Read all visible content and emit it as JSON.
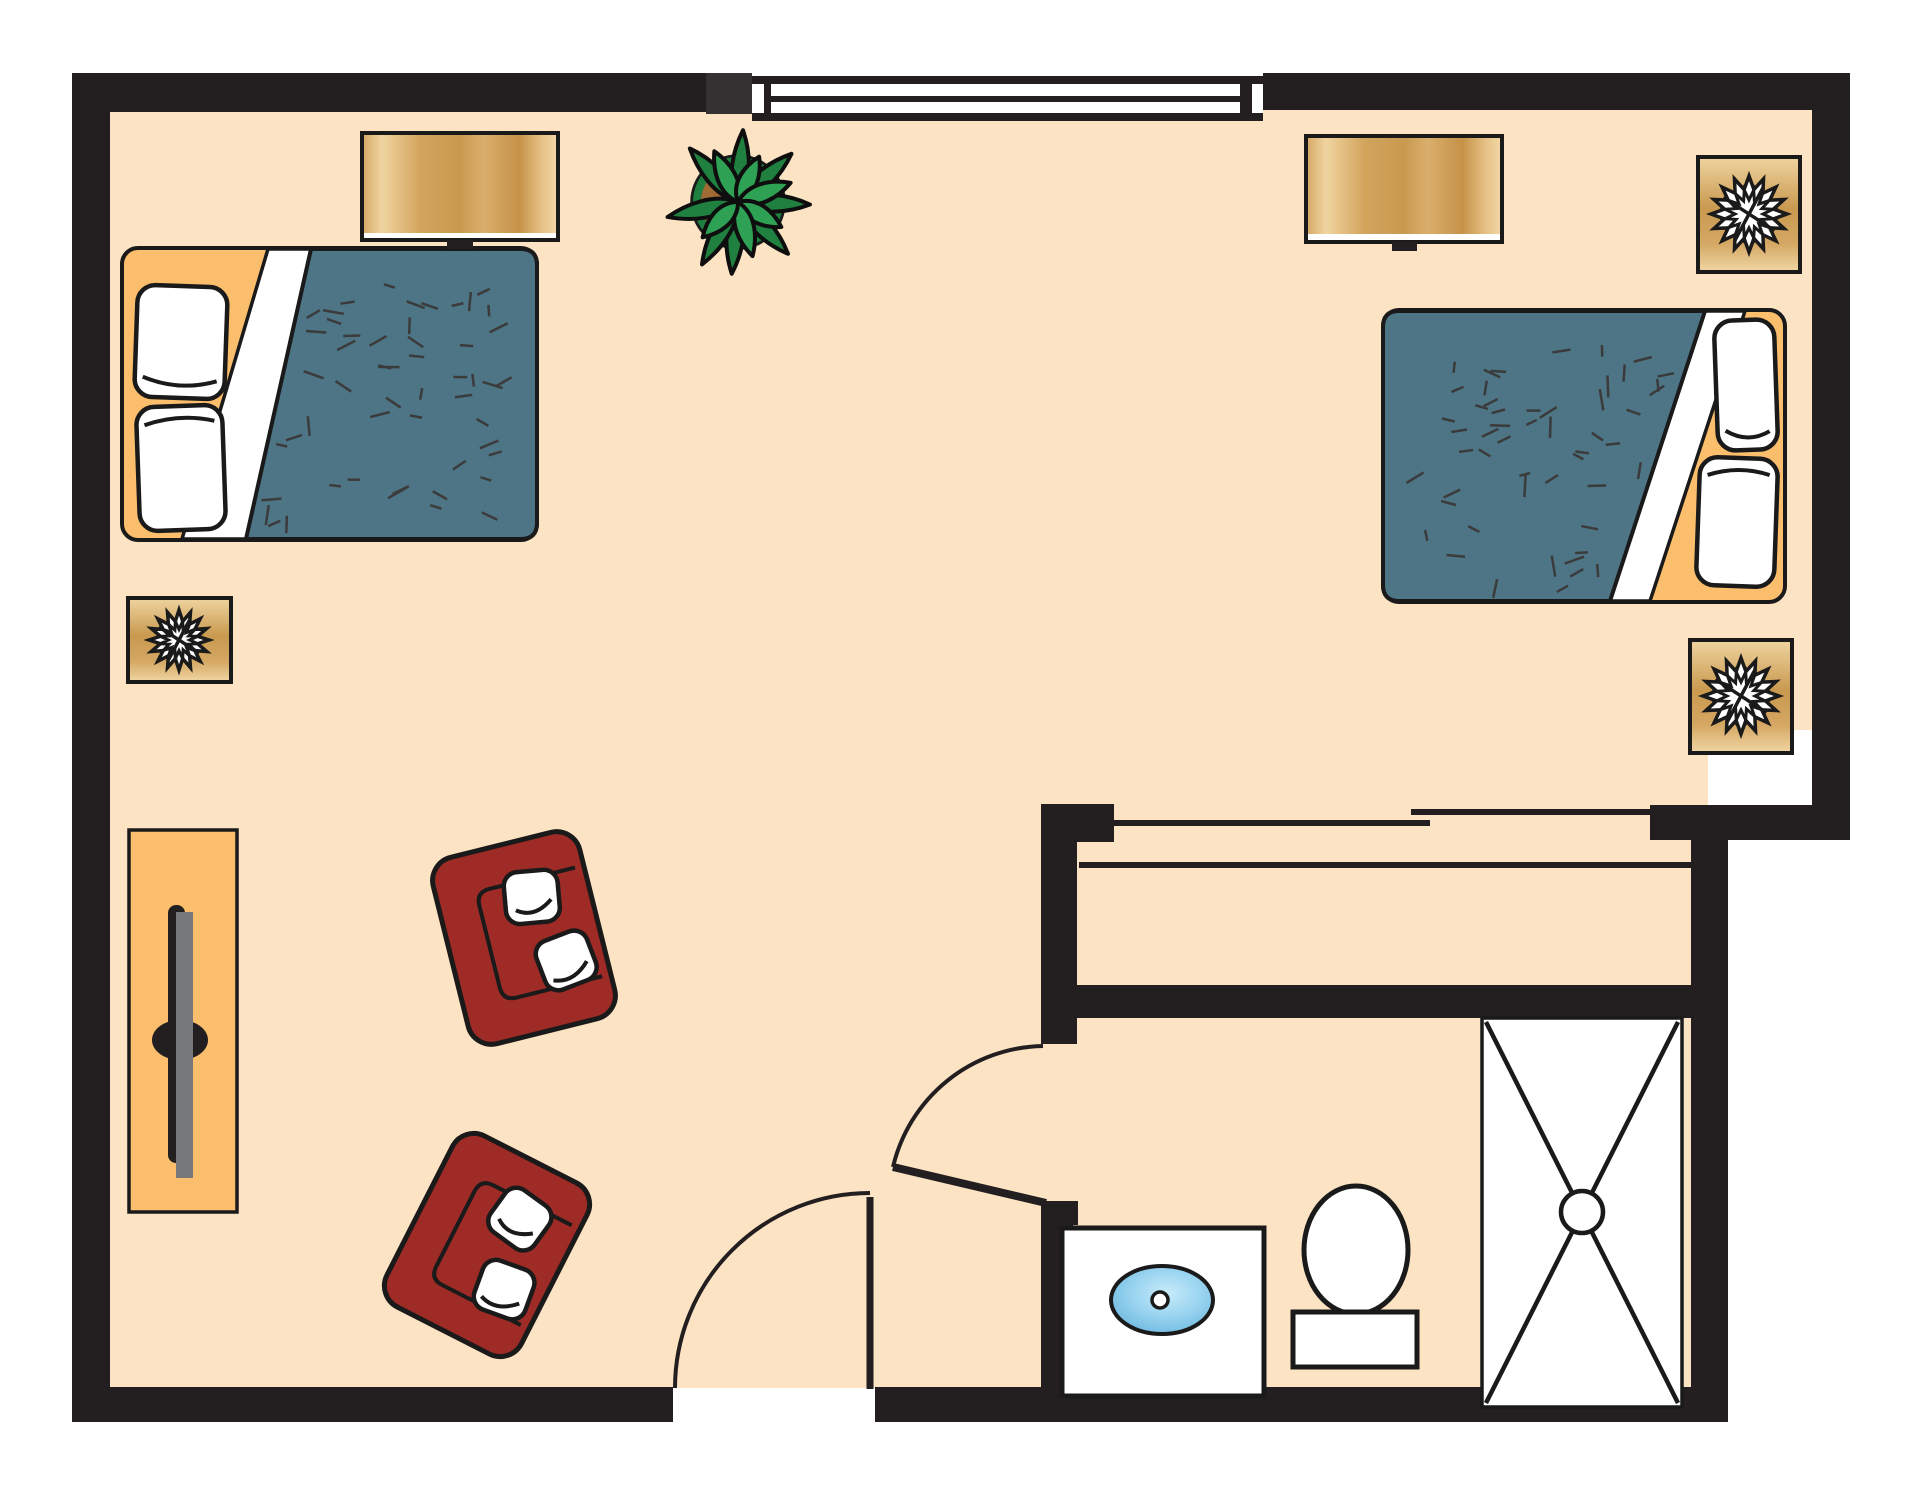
{
  "meta": {
    "name": "bedroom-suite-floor-plan",
    "canvas": {
      "w": 1916,
      "h": 1492
    }
  },
  "palette": {
    "background": "#FFFFFF",
    "floor": "#FCE3C3",
    "wall": "#231F20",
    "wallJamb": "#353132",
    "outline": "#1A1A1A",
    "white": "#FFFFFF",
    "bedFrame": "#FBBE6C",
    "blanket": "#4D7585",
    "blanketDash": "#3B3B3B",
    "chair": "#9E2B26",
    "tvGray": "#77787B",
    "plantLeafDark": "#1F8040",
    "plantLeafLight": "#2FA155",
    "plantPot": "#A06A35",
    "dresserStops": [
      [
        "0",
        "#D4A763"
      ],
      [
        "0.1",
        "#F0D4A0"
      ],
      [
        "0.3",
        "#D2A45C"
      ],
      [
        "0.5",
        "#C9994F"
      ],
      [
        "0.62",
        "#D9AE6C"
      ],
      [
        "0.8",
        "#C59247"
      ],
      [
        "0.92",
        "#E7C288"
      ],
      [
        "1",
        "#F2D8A6"
      ]
    ],
    "tableStops": [
      [
        "0",
        "#EFD4A0"
      ],
      [
        "0.45",
        "#C9994F"
      ],
      [
        "0.75",
        "#D4A763"
      ],
      [
        "1",
        "#F0D6A4"
      ]
    ],
    "sinkStops": [
      [
        "0",
        "#C8EBFA"
      ],
      [
        "0.45",
        "#9AD4F0"
      ],
      [
        "1",
        "#5FB0DA"
      ]
    ]
  },
  "floor": {
    "rects": [
      [
        90,
        90,
        1742,
        640
      ],
      [
        90,
        700,
        1618,
        688
      ]
    ]
  },
  "walls": [
    {
      "name": "wall-left",
      "r": [
        72,
        73,
        38,
        1347
      ]
    },
    {
      "name": "wall-top-left",
      "r": [
        72,
        73,
        634,
        39
      ]
    },
    {
      "name": "wall-top-window-jamb",
      "r": [
        706,
        73,
        46,
        41
      ],
      "fill": "wallJamb"
    },
    {
      "name": "wall-top-right",
      "r": [
        1263,
        73,
        587,
        37
      ]
    },
    {
      "name": "wall-right-upper",
      "r": [
        1812,
        73,
        38,
        767
      ]
    },
    {
      "name": "wall-step",
      "r": [
        1650,
        805,
        200,
        35
      ]
    },
    {
      "name": "wall-bath-right",
      "r": [
        1691,
        838,
        37,
        584
      ]
    },
    {
      "name": "wall-bottom-left",
      "r": [
        72,
        1387,
        601,
        35
      ]
    },
    {
      "name": "wall-bottom-right",
      "r": [
        875,
        1387,
        853,
        35
      ]
    },
    {
      "name": "wall-closet-stub",
      "r": [
        1041,
        804,
        73,
        38
      ]
    },
    {
      "name": "wall-closet-left",
      "r": [
        1041,
        804,
        36,
        240
      ]
    },
    {
      "name": "wall-closet-bath-divider",
      "r": [
        1077,
        985,
        651,
        33
      ]
    },
    {
      "name": "wall-bath-door-jamb",
      "r": [
        1041,
        1201,
        37,
        24
      ]
    },
    {
      "name": "wall-bath-left-lower",
      "r": [
        1041,
        1225,
        32,
        165
      ]
    }
  ],
  "window": {
    "base": [
      752,
      76,
      511,
      45
    ],
    "topLine": [
      752,
      76,
      511,
      8
    ],
    "bottomLine": [
      752,
      113,
      511,
      8
    ],
    "leftCap": [
      764,
      84,
      7,
      29
    ],
    "rightCap": [
      1240,
      84,
      12,
      29
    ],
    "mullion": [
      771,
      96,
      469,
      6
    ]
  },
  "closet": {
    "doorTracks": [
      [
        1114,
        823,
        1430,
        823
      ],
      [
        1411,
        812,
        1650,
        812
      ]
    ],
    "backLine": [
      1079,
      865,
      1691,
      865
    ],
    "lineWidth": 6
  },
  "doors": [
    {
      "name": "entry-door",
      "leaf": [
        870,
        1197,
        870,
        1389
      ],
      "leafWidth": 7,
      "arc": "M 675 1388 A 195 195 0 0 1 870 1193",
      "arcWidth": 4
    },
    {
      "name": "bathroom-door",
      "leaf": [
        1046,
        1203,
        893,
        1167
      ],
      "leafWidth": 8,
      "arc": "M 1043 1046 A 157 157 0 0 0 893 1167",
      "arcWidth": 4
    }
  ],
  "beds": [
    {
      "name": "bed-left",
      "frame": [
        122,
        248,
        415,
        292
      ],
      "cornerRadius": 16,
      "sheetBand": [
        [
          268,
          249
        ],
        [
          311,
          249
        ],
        [
          246,
          539
        ],
        [
          182,
          539
        ]
      ],
      "blanket": "M 311 249 L 521 249 Q 537 249 537 265 L 537 523 Q 537 539 521 539 L 246 539 Z",
      "dash": {
        "seed": 7,
        "count": 52,
        "xRange": [
          258,
          522
        ],
        "yRange": [
          263,
          527
        ],
        "edgeTop": [
          311,
          249
        ],
        "edgeBottom": [
          246,
          539
        ],
        "side": "right"
      },
      "pillows": [
        {
          "r": [
            136,
            286,
            90,
            112
          ],
          "rot": 2,
          "crease": "bottom"
        },
        {
          "r": [
            138,
            406,
            86,
            124
          ],
          "rot": -2,
          "crease": "top"
        }
      ]
    },
    {
      "name": "bed-right",
      "frame": [
        1383,
        310,
        402,
        292
      ],
      "cornerRadius": 16,
      "sheetBand": [
        [
          1705,
          311
        ],
        [
          1745,
          311
        ],
        [
          1650,
          601
        ],
        [
          1610,
          601
        ]
      ],
      "blanket": "M 1705 311 L 1399 311 Q 1383 311 1383 327 L 1383 585 Q 1383 601 1399 601 L 1610 601 Z",
      "dash": {
        "seed": 13,
        "count": 52,
        "xRange": [
          1396,
          1692
        ],
        "yRange": [
          325,
          589
        ],
        "edgeTop": [
          1705,
          311
        ],
        "edgeBottom": [
          1610,
          601
        ],
        "side": "left"
      },
      "pillows": [
        {
          "r": [
            1716,
            320,
            60,
            130
          ],
          "rot": -2,
          "crease": "bottom"
        },
        {
          "r": [
            1698,
            458,
            78,
            128
          ],
          "rot": 2,
          "crease": "top"
        }
      ]
    }
  ],
  "dressers": [
    {
      "name": "dresser-left",
      "outer": [
        362,
        133,
        196,
        107
      ],
      "body": [
        362,
        133,
        196,
        100
      ],
      "strip": [
        362,
        233,
        196,
        7
      ],
      "knob": [
        447,
        240,
        26,
        9
      ]
    },
    {
      "name": "dresser-right",
      "outer": [
        1306,
        136,
        196,
        106
      ],
      "body": [
        1306,
        136,
        196,
        98
      ],
      "strip": [
        1306,
        234,
        196,
        8
      ],
      "knob": [
        1392,
        242,
        25,
        9
      ]
    }
  ],
  "lampTables": [
    {
      "name": "lamp-table-left",
      "r": [
        128,
        598,
        103,
        84
      ],
      "star": {
        "c": [
          179,
          640
        ],
        "rOut": 30,
        "rIn": 19
      }
    },
    {
      "name": "lamp-table-top-right",
      "r": [
        1698,
        157,
        102,
        115
      ],
      "star": {
        "c": [
          1749,
          214
        ],
        "rOut": 38,
        "rIn": 25
      }
    },
    {
      "name": "lamp-table-mid-right",
      "r": [
        1690,
        640,
        102,
        113
      ],
      "star": {
        "c": [
          1741,
          696
        ],
        "rOut": 38,
        "rIn": 25
      }
    }
  ],
  "tvConsole": {
    "name": "tv-console",
    "r": [
      129,
      830,
      108,
      382
    ],
    "barBlack": [
      168,
      905,
      17,
      258
    ],
    "barGray": [
      176,
      912,
      17,
      266
    ],
    "screenEllipse": [
      180,
      1040,
      28,
      20
    ]
  },
  "armchairs": [
    {
      "name": "armchair-upper",
      "center": [
        524,
        938
      ],
      "rot": -14,
      "w": 151,
      "h": 192
    },
    {
      "name": "armchair-lower",
      "center": [
        487,
        1245
      ],
      "rot": 27,
      "w": 151,
      "h": 192
    }
  ],
  "chairTemplate": {
    "cornerRadius": 24,
    "seatPath": "M 142 40 L 54 40 Q 40 40 40 54 L 40 138 Q 40 152 54 152 L 142 152",
    "pillows": [
      {
        "r": [
          66,
          32,
          54,
          52
        ],
        "rot": 9,
        "crease": "M 10 38 Q 28 48 46 30"
      },
      {
        "r": [
          84,
          102,
          54,
          52
        ],
        "rot": -7,
        "crease": "M 8 40 Q 26 50 46 34"
      }
    ]
  },
  "plant": {
    "name": "potted-plant",
    "center": [
      738,
      202
    ],
    "potRadius": 46,
    "outerLeaves": {
      "angles": [
        -86,
        -42,
        2,
        46,
        95,
        120,
        168,
        -132
      ],
      "len": 72,
      "halfWidth": 14
    },
    "innerLeaves": {
      "angles": [
        -115,
        -65,
        -20,
        30,
        75,
        135
      ],
      "len": 56,
      "halfWidth": 15
    }
  },
  "bathroom": {
    "vanity": {
      "name": "sink-vanity",
      "r": [
        1062,
        1228,
        202,
        168
      ]
    },
    "sink": {
      "c": [
        1162,
        1300
      ],
      "rx": 51,
      "ry": 34,
      "drain": {
        "c": [
          1160,
          1300
        ],
        "r": 8
      }
    },
    "toilet": {
      "name": "toilet",
      "bowl": {
        "c": [
          1356,
          1250
        ],
        "rx": 52,
        "ry": 64
      },
      "tank": [
        1293,
        1312,
        124,
        55
      ]
    },
    "shower": {
      "name": "shower",
      "r": [
        1482,
        1018,
        200,
        389
      ],
      "drain": {
        "c": [
          1582,
          1212
        ],
        "r": 21
      },
      "lineInset": 4
    }
  }
}
